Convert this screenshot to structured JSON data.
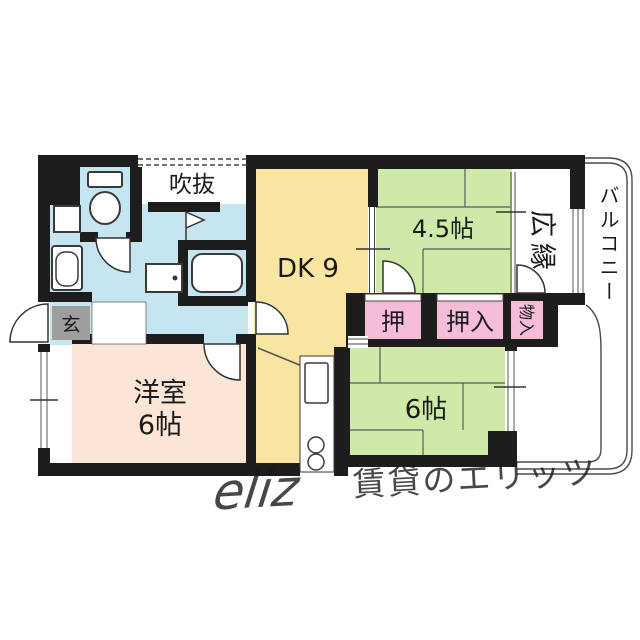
{
  "rooms": {
    "fukinuke": {
      "label": "吹抜"
    },
    "dk": {
      "label": "DK 9"
    },
    "jp45": {
      "label": "4.5帖"
    },
    "hiroen": {
      "label": "広縁"
    },
    "balcony": {
      "label": "バルコニー"
    },
    "oshi": {
      "label": "押"
    },
    "oshiire": {
      "label": "押入"
    },
    "monoire": {
      "label": "物入"
    },
    "jp6": {
      "label": "6帖"
    },
    "yoshitsu": {
      "line1": "洋室",
      "line2": "6帖"
    },
    "genkan": {
      "label": "玄"
    }
  },
  "watermark": {
    "logo": "eliz",
    "text": "賃貸のエリッツ"
  },
  "colors": {
    "wall": "#1d1d1d",
    "water_area": "#c5e6f1",
    "dk": "#f8e5a1",
    "tatami": "#cfe9a8",
    "closet": "#f5bdd8",
    "western_room": "#fbe5d6",
    "genkan_bg": "#9e9e9e",
    "watermark": "#c6c6c6"
  }
}
